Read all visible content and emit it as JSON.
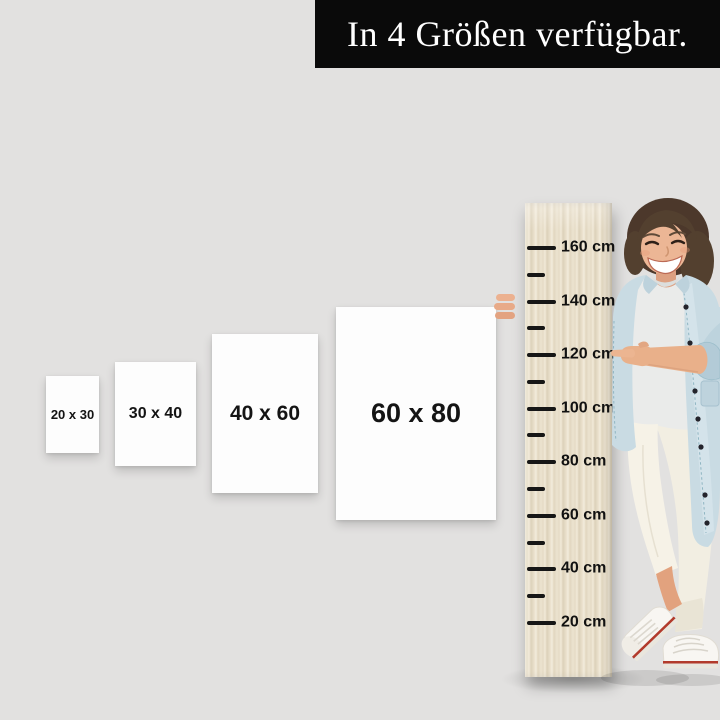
{
  "page": {
    "background_color": "#e2e1e0",
    "description": "Product size guide: four white canvas sizes beside a wooden height ruler held by a smiling woman"
  },
  "banner": {
    "text": "In 4 Größen verfügbar.",
    "background_color": "#0a0a0a",
    "text_color": "#ffffff"
  },
  "size_options": [
    {
      "label": "20 x 30"
    },
    {
      "label": "30 x 40"
    },
    {
      "label": "40 x 60"
    },
    {
      "label": "60 x 80"
    }
  ],
  "ruler": {
    "unit": "cm",
    "wood_color": "#e8dec9",
    "tick_color": "#161616",
    "marks": [
      {
        "label": "160 cm"
      },
      {
        "label": "140 cm"
      },
      {
        "label": "120 cm"
      },
      {
        "label": "100 cm"
      },
      {
        "label": "80 cm"
      },
      {
        "label": "60 cm"
      },
      {
        "label": "40 cm"
      },
      {
        "label": "20 cm"
      }
    ]
  },
  "figure": {
    "alt": "Smiling woman with short brown hair in a light denim jacket, white shirt, white trousers and white sneakers, pointing at the 120 cm mark"
  }
}
